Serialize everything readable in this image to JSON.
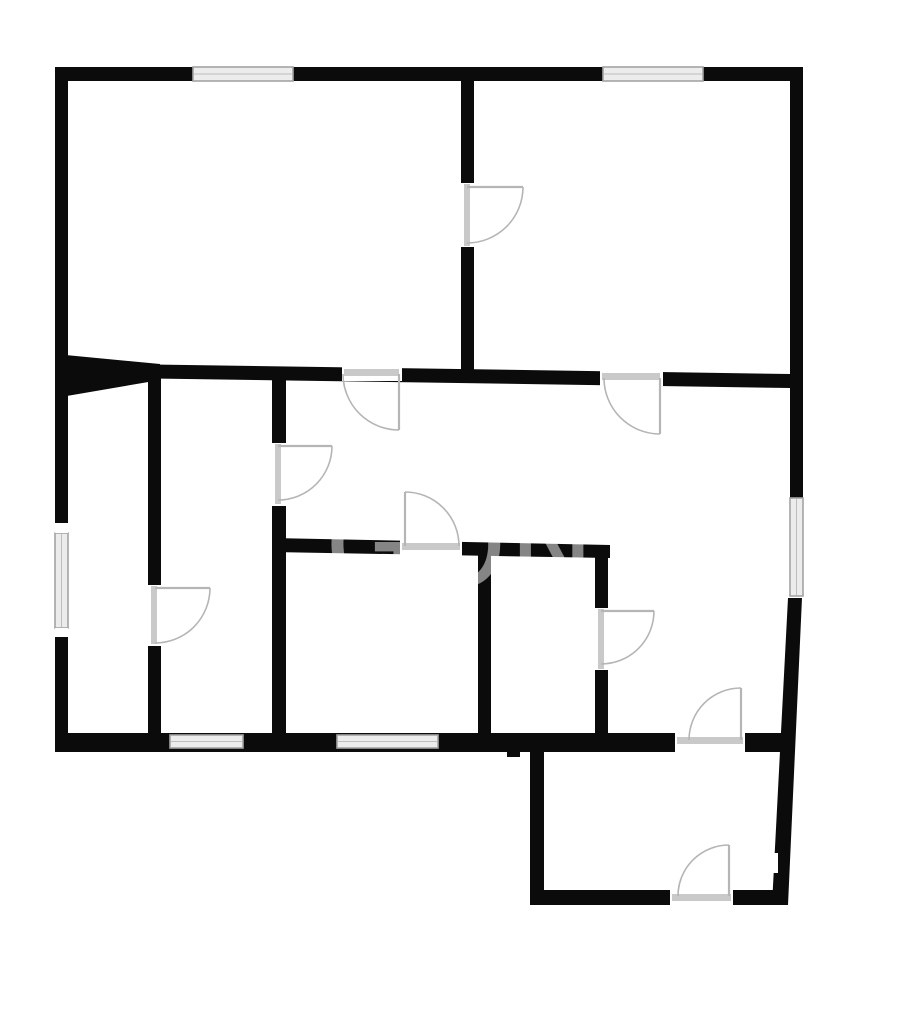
{
  "canvas": {
    "width": 918,
    "height": 1024,
    "background": "#ffffff"
  },
  "colors": {
    "wall": "#0b0b0b",
    "window_fill": "#ececec",
    "window_edge": "#a3a3a3",
    "window_mid": "#bdbdbd",
    "threshold": "#c9c9c9",
    "door": "#b5b5b5",
    "gap": "#ffffff",
    "watermark": "rgba(255,255,255,0.5)"
  },
  "watermark": {
    "text": "GON",
    "x": 325,
    "y": 586,
    "font_size": 115,
    "letter_spacing": 2
  },
  "walls": [
    {
      "type": "rect",
      "x": 55,
      "y": 67,
      "w": 748,
      "h": 14
    },
    {
      "type": "rect",
      "x": 55,
      "y": 67,
      "w": 13,
      "h": 685
    },
    {
      "type": "rect",
      "x": 790,
      "y": 67,
      "w": 13,
      "h": 431
    },
    {
      "type": "poly",
      "points": [
        [
          788,
          598
        ],
        [
          802,
          598
        ],
        [
          788,
          905
        ],
        [
          772,
          905
        ]
      ]
    },
    {
      "type": "rect",
      "x": 55,
      "y": 733,
      "w": 733,
      "h": 19
    },
    {
      "type": "rect",
      "x": 461,
      "y": 81,
      "w": 13,
      "h": 300
    },
    {
      "type": "poly",
      "points": [
        [
          55,
          363
        ],
        [
          790,
          374
        ],
        [
          790,
          388
        ],
        [
          55,
          377
        ]
      ]
    },
    {
      "type": "poly",
      "points": [
        [
          55,
          354
        ],
        [
          160,
          364
        ],
        [
          160,
          380
        ],
        [
          55,
          398
        ]
      ]
    },
    {
      "type": "rect",
      "x": 148,
      "y": 376,
      "w": 13,
      "h": 357
    },
    {
      "type": "rect",
      "x": 272,
      "y": 376,
      "w": 14,
      "h": 357
    },
    {
      "type": "poly",
      "points": [
        [
          272,
          538
        ],
        [
          610,
          545
        ],
        [
          610,
          558
        ],
        [
          272,
          552
        ]
      ]
    },
    {
      "type": "rect",
      "x": 478,
      "y": 552,
      "w": 13,
      "h": 181
    },
    {
      "type": "rect",
      "x": 595,
      "y": 552,
      "w": 13,
      "h": 181
    },
    {
      "type": "rect",
      "x": 530,
      "y": 752,
      "w": 14,
      "h": 153
    },
    {
      "type": "rect",
      "x": 530,
      "y": 890,
      "w": 258,
      "h": 15
    },
    {
      "type": "rect",
      "x": 507,
      "y": 745,
      "w": 13,
      "h": 12
    }
  ],
  "door_gaps": [
    {
      "x": 461,
      "y": 183,
      "w": 13,
      "h": 64
    },
    {
      "x": 342,
      "y": 366,
      "w": 60,
      "h": 15
    },
    {
      "x": 600,
      "y": 371,
      "w": 63,
      "h": 15
    },
    {
      "x": 148,
      "y": 585,
      "w": 13,
      "h": 61
    },
    {
      "x": 272,
      "y": 443,
      "w": 14,
      "h": 63
    },
    {
      "x": 400,
      "y": 540,
      "w": 62,
      "h": 16
    },
    {
      "x": 675,
      "y": 733,
      "w": 70,
      "h": 19
    },
    {
      "x": 595,
      "y": 608,
      "w": 13,
      "h": 62
    },
    {
      "x": 670,
      "y": 890,
      "w": 63,
      "h": 15
    }
  ],
  "windows": [
    {
      "x": 193,
      "y": 67,
      "w": 100,
      "h": 14,
      "orient": "h"
    },
    {
      "x": 603,
      "y": 67,
      "w": 100,
      "h": 14,
      "orient": "h"
    },
    {
      "x": 55,
      "y": 533,
      "w": 13,
      "h": 95,
      "orient": "v"
    },
    {
      "x": 790,
      "y": 498,
      "w": 13,
      "h": 98,
      "orient": "v"
    },
    {
      "x": 170,
      "y": 735,
      "w": 73,
      "h": 13,
      "orient": "h"
    },
    {
      "x": 337,
      "y": 735,
      "w": 101,
      "h": 13,
      "orient": "h"
    }
  ],
  "white_patches": [
    {
      "x": 55,
      "y": 523,
      "w": 13,
      "h": 10
    },
    {
      "x": 55,
      "y": 628,
      "w": 13,
      "h": 9
    },
    {
      "x": 771,
      "y": 853,
      "w": 7,
      "h": 20
    }
  ],
  "thresholds": [
    {
      "x": 464,
      "y": 184,
      "w": 6,
      "h": 62
    },
    {
      "x": 344,
      "y": 369,
      "w": 55,
      "h": 7
    },
    {
      "x": 602,
      "y": 373,
      "w": 58,
      "h": 7
    },
    {
      "x": 151,
      "y": 586,
      "w": 6,
      "h": 58
    },
    {
      "x": 275,
      "y": 444,
      "w": 6,
      "h": 60
    },
    {
      "x": 402,
      "y": 543,
      "w": 58,
      "h": 7
    },
    {
      "x": 677,
      "y": 737,
      "w": 66,
      "h": 7
    },
    {
      "x": 598,
      "y": 609,
      "w": 6,
      "h": 60
    },
    {
      "x": 672,
      "y": 894,
      "w": 59,
      "h": 7
    }
  ],
  "doors": [
    {
      "leaf": [
        467,
        187,
        523,
        187
      ],
      "arc": {
        "sx": 523,
        "sy": 187,
        "ex": 467,
        "ey": 243,
        "r": 56,
        "sweep": 1
      }
    },
    {
      "leaf": [
        399,
        374,
        399,
        430
      ],
      "arc": {
        "sx": 343,
        "sy": 374,
        "ex": 399,
        "ey": 430,
        "r": 56,
        "sweep": 0
      }
    },
    {
      "leaf": [
        660,
        378,
        660,
        434
      ],
      "arc": {
        "sx": 604,
        "sy": 378,
        "ex": 660,
        "ey": 434,
        "r": 56,
        "sweep": 0
      }
    },
    {
      "leaf": [
        155,
        588,
        210,
        588
      ],
      "arc": {
        "sx": 210,
        "sy": 588,
        "ex": 155,
        "ey": 643,
        "r": 55,
        "sweep": 1
      }
    },
    {
      "leaf": [
        278,
        446,
        332,
        446
      ],
      "arc": {
        "sx": 332,
        "sy": 446,
        "ex": 278,
        "ey": 500,
        "r": 54,
        "sweep": 1
      }
    },
    {
      "leaf": [
        405,
        546,
        405,
        492
      ],
      "arc": {
        "sx": 405,
        "sy": 492,
        "ex": 459,
        "ey": 546,
        "r": 54,
        "sweep": 1
      }
    },
    {
      "leaf": [
        741,
        740,
        741,
        688
      ],
      "arc": {
        "sx": 689,
        "sy": 740,
        "ex": 741,
        "ey": 688,
        "r": 52,
        "sweep": 1
      }
    },
    {
      "leaf": [
        601,
        611,
        654,
        611
      ],
      "arc": {
        "sx": 654,
        "sy": 611,
        "ex": 601,
        "ey": 664,
        "r": 53,
        "sweep": 1
      }
    },
    {
      "leaf": [
        729,
        896,
        729,
        845
      ],
      "arc": {
        "sx": 678,
        "sy": 896,
        "ex": 729,
        "ey": 845,
        "r": 51,
        "sweep": 1
      }
    }
  ]
}
